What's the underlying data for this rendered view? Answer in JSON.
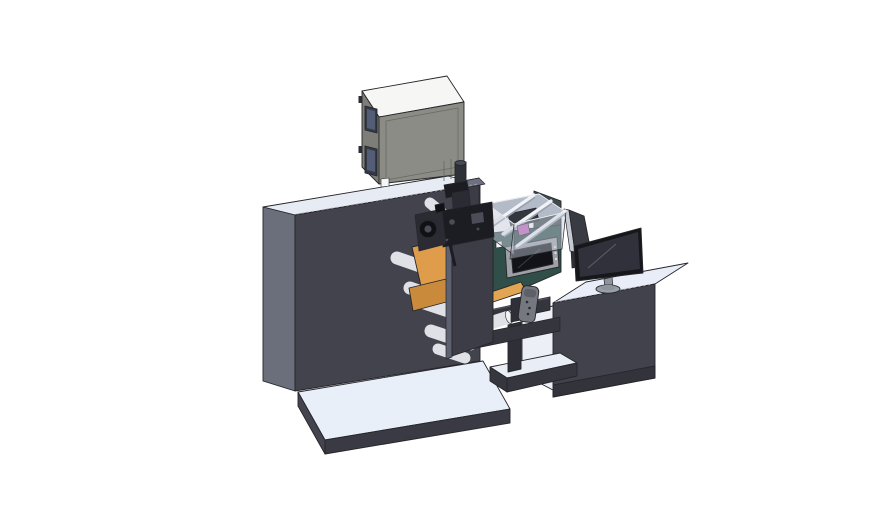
{
  "scene": {
    "description": "3D CAD isometric render of an industrial roll-fed label printing machine line with main press housing, top electrical cabinet, web rollers with orange media, digital print module with HMI touchscreen, and an operator desk with monitor",
    "background": "#ffffff"
  },
  "parts": {
    "press_unit": "main press housing",
    "electrical_cabinet": "electrical cabinet",
    "vent_cylinder": "cylindrical vent cap",
    "base_plate": "machine base platform",
    "print_head": "print head mechanism",
    "rollers": "web guide rollers",
    "web": "orange label web",
    "side_plate": "side frame plate",
    "print_module": "digital print module",
    "hmi": "HMI touchscreen panel",
    "enclosure": "transparent print enclosure",
    "conveyor": "output conveyor bridge",
    "remote": "handheld control pendant",
    "desk": "operator desk cabinet",
    "monitor": "desktop monitor",
    "rear_panel": "rear display panel"
  },
  "colors": {
    "outline": "#26262b",
    "speckle": "#a9aeb8",
    "machine_top": "#e6ebf4",
    "machine_side": "#6b6e7b",
    "machine_front": "#42434c",
    "column": "#3b3c45",
    "column_top": "#6e7280",
    "base_top": "#e9eff8",
    "base_front": "#393a43",
    "base_left": "#43444e",
    "cab_top": "#f6f7f4",
    "cab_left": "#7d7e77",
    "cab_front": "#8b8c85",
    "cab_seam": "#696a63",
    "cab_window": "#333a46",
    "cab_window_in": "#535e76",
    "cab_label": "#f4f6f8",
    "cyl_body": "#2e3138",
    "cyl_cap": "#474b55",
    "backwall": "#3e4a4b",
    "desk_top": "#e8edf7",
    "desk_front": "#41424b",
    "desk_plinth": "#32333b",
    "bay_white": "#eceff6",
    "shelf_top": "#e8edf6",
    "shelf_base": "#35363e",
    "post_dark": "#2e2f37",
    "panel_back": "#393b42",
    "panel_edge": "#c6cbd3",
    "teal_front": "#2f4f48",
    "teal_side": "#24403a",
    "teal_dot": "#1b2723",
    "hmi_frame": "#9da0a6",
    "hmi_screen": "#121318",
    "hmi_glint": "#3a3d46",
    "btn_dot": "#d9dbdf",
    "encl_glass": "#c6cdd9",
    "encl_floor": "#b3bbc8",
    "encl_rail": "#f0f2f7",
    "encl_rail_shadow": "#99a0ad",
    "encl_mag": "#c065bd",
    "encl_carriage": "#34373e",
    "beam_dark": "#34353d",
    "beam_top": "#50525e",
    "web_main": "#df9d4b",
    "web_dark": "#c98a3c",
    "web_belt": "#e2a553",
    "roller_body": "#dfe1e7",
    "roller_end": "#f0f2f5",
    "plate_front": "#3c3d46",
    "plate_edge": "#5e6170",
    "mech_deep": "#101114",
    "mech_dark": "#1c1d22",
    "mech_mid": "#2a2b33",
    "mech_lit": "#4a4d58",
    "mon_bezel": "#16171b",
    "mon_screen": "#30313a",
    "mon_glint": "#5a5f6a",
    "mon_stand": "#8f949c",
    "mon_base": "#9aa0aa",
    "remote_body": "#75787f",
    "remote_shade": "#5d6067",
    "remote_dot": "#2b2b30"
  }
}
